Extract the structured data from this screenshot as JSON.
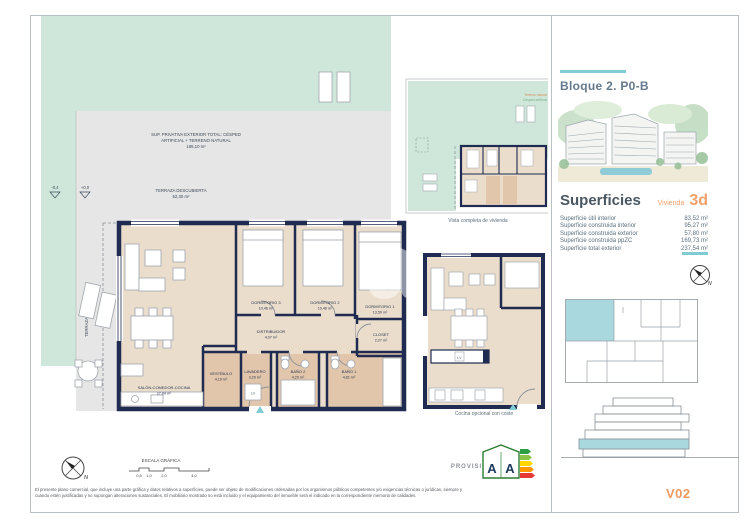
{
  "colors": {
    "accent_teal": "#7fccd3",
    "accent_orange": "#ef9a60",
    "wall_navy": "#1f2b50",
    "room_cream": "#eaddcc",
    "wet_room_tan": "#e2c6ab",
    "lawn_green": "#cfe7da",
    "terrace_gray": "#e6e6e6",
    "slate_text": "#5b707f"
  },
  "sheet": {
    "provisional": "PROVISIONAL",
    "version": "V02",
    "disclaimer_line1": "El presente plano comercial, que incluye una parte gráfica y datos relativos a superficies, puede ser objeto de modificaciones ordenadas por los organismos públicos competentes y/o exigencias técnicas o jurídicas, siempre y",
    "disclaimer_line2": "cuando estén justificadas y no supongan alteraciones sustanciales. El mobiliario mostrado no está incluido y el equipamiento del inmueble será el indicado en la correspondiente memoria de calidades."
  },
  "scale_bar": {
    "title": "ESCALA GRÁFICA",
    "ticks": [
      "0,5",
      "1,0",
      "2,0",
      "4,0"
    ]
  },
  "compass": {
    "north": "N"
  },
  "energy": {
    "letter_left": "A",
    "letter_right": "A"
  },
  "plan": {
    "watermark": "a",
    "appliance": "LV",
    "levels": {
      "outer": "-0,4",
      "inner": "+0,0"
    },
    "outdoor": {
      "lawn_line1": "SUP. PRIVATIVA EXTERIOR TOTAL: CÉSPED",
      "lawn_line2": "ARTIFICIAL + TERRENO NATURAL",
      "lawn_area": "185,10 m²",
      "terrace_label": "TERRAZA DESCUBIERTA",
      "terrace_area": "52,30 m²",
      "covered_terrace": "TERRAZA CUBIERTA"
    },
    "rooms": [
      {
        "name": "DORMITORIO 3",
        "area": "10,46 m²"
      },
      {
        "name": "DORMITORIO 2",
        "area": "10,46 m²"
      },
      {
        "name": "DORMITORIO 1",
        "area": "13,50 m²"
      },
      {
        "name": "DISTRIBUIDOR",
        "area": "4,07 m²"
      },
      {
        "name": "CLOSET",
        "area": "2,27 m²"
      },
      {
        "name": "VESTÍBULO",
        "area": "4,19 m²"
      },
      {
        "name": "LAVADERO",
        "area": "3,20 m²"
      },
      {
        "name": "BAÑO 2",
        "area": "4,29 m²"
      },
      {
        "name": "BAÑO 1",
        "area": "4,81 m²"
      },
      {
        "name": "SALÓN-COMEDOR-COCINA",
        "area": "27,84 m²"
      }
    ]
  },
  "insets": {
    "overview": {
      "caption": "Vista completa de vivienda",
      "legend_1": "Terreno natural",
      "legend_2": "Césped artificial"
    },
    "kitchen": {
      "caption": "Cocina opcional con coste"
    }
  },
  "panel": {
    "block_title": "Bloque 2. P0-B",
    "superficies_title": "Superficies",
    "vivienda_label": "Vivienda",
    "vivienda_type": "3d",
    "rows": [
      {
        "label": "Superficie útil interior",
        "value": "83,52 m²"
      },
      {
        "label": "Superficie construida interior",
        "value": "95,27 m²"
      },
      {
        "label": "Superficie construida exterior",
        "value": "57,80 m²"
      },
      {
        "label": "Superficie construida ppZC",
        "value": "169,73 m²"
      },
      {
        "label": "Superficie total exterior",
        "value": "237,54 m²"
      }
    ]
  }
}
